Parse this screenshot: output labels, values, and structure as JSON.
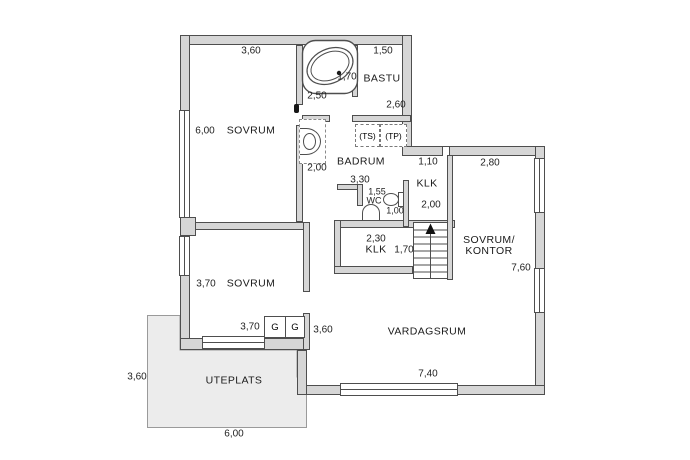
{
  "plan": {
    "rooms": [
      {
        "id": "sovrum-1",
        "label": "SOVRUM"
      },
      {
        "id": "sovrum-2",
        "label": "SOVRUM"
      },
      {
        "id": "badrum",
        "label": "BADRUM"
      },
      {
        "id": "bastu",
        "label": "BASTU"
      },
      {
        "id": "wc",
        "label": "WC"
      },
      {
        "id": "klk-upper",
        "label": "KLK"
      },
      {
        "id": "klk-lower",
        "label": "KLK"
      },
      {
        "id": "sovrum-kontor",
        "label": "SOVRUM/",
        "label2": "KONTOR"
      },
      {
        "id": "vardagsrum",
        "label": "VARDAGSRUM"
      },
      {
        "id": "uteplats",
        "label": "UTEPLATS"
      }
    ],
    "dimensions": [
      {
        "id": "sovrum1-width",
        "value": "3,60"
      },
      {
        "id": "sovrum1-height",
        "value": "6,00"
      },
      {
        "id": "bathtub-width",
        "value": "1,70"
      },
      {
        "id": "bath-area-height",
        "value": "2,50"
      },
      {
        "id": "bastu-width",
        "value": "1,50"
      },
      {
        "id": "bastu-height",
        "value": "2,60"
      },
      {
        "id": "badrum-left-height",
        "value": "2,00"
      },
      {
        "id": "badrum-width",
        "value": "3,30"
      },
      {
        "id": "wc-width",
        "value": "1,55"
      },
      {
        "id": "wc-depth",
        "value": "1,00"
      },
      {
        "id": "kontor-top-left",
        "value": "1,10"
      },
      {
        "id": "kontor-top-right",
        "value": "2,80"
      },
      {
        "id": "klk-upper-height",
        "value": "2,00"
      },
      {
        "id": "klk-lower-width",
        "value": "2,30"
      },
      {
        "id": "klk-lower-height",
        "value": "1,70"
      },
      {
        "id": "kontor-height",
        "value": "7,60"
      },
      {
        "id": "sovrum2-height",
        "value": "3,70"
      },
      {
        "id": "sovrum2-width",
        "value": "3,70"
      },
      {
        "id": "hall-width",
        "value": "3,60"
      },
      {
        "id": "vardagsrum-width",
        "value": "7,40"
      },
      {
        "id": "uteplats-height",
        "value": "3,60"
      },
      {
        "id": "uteplats-width",
        "value": "6,00"
      }
    ],
    "closets": [
      {
        "label": "G"
      },
      {
        "label": "G"
      }
    ],
    "appliances": [
      {
        "label": "(TS)"
      },
      {
        "label": "(TP)"
      }
    ],
    "colors": {
      "wall_fill": "#d6d6d6",
      "wall_stroke": "#4e4e4e",
      "patio_fill": "#ececec",
      "text": "#1f1f1f"
    }
  }
}
